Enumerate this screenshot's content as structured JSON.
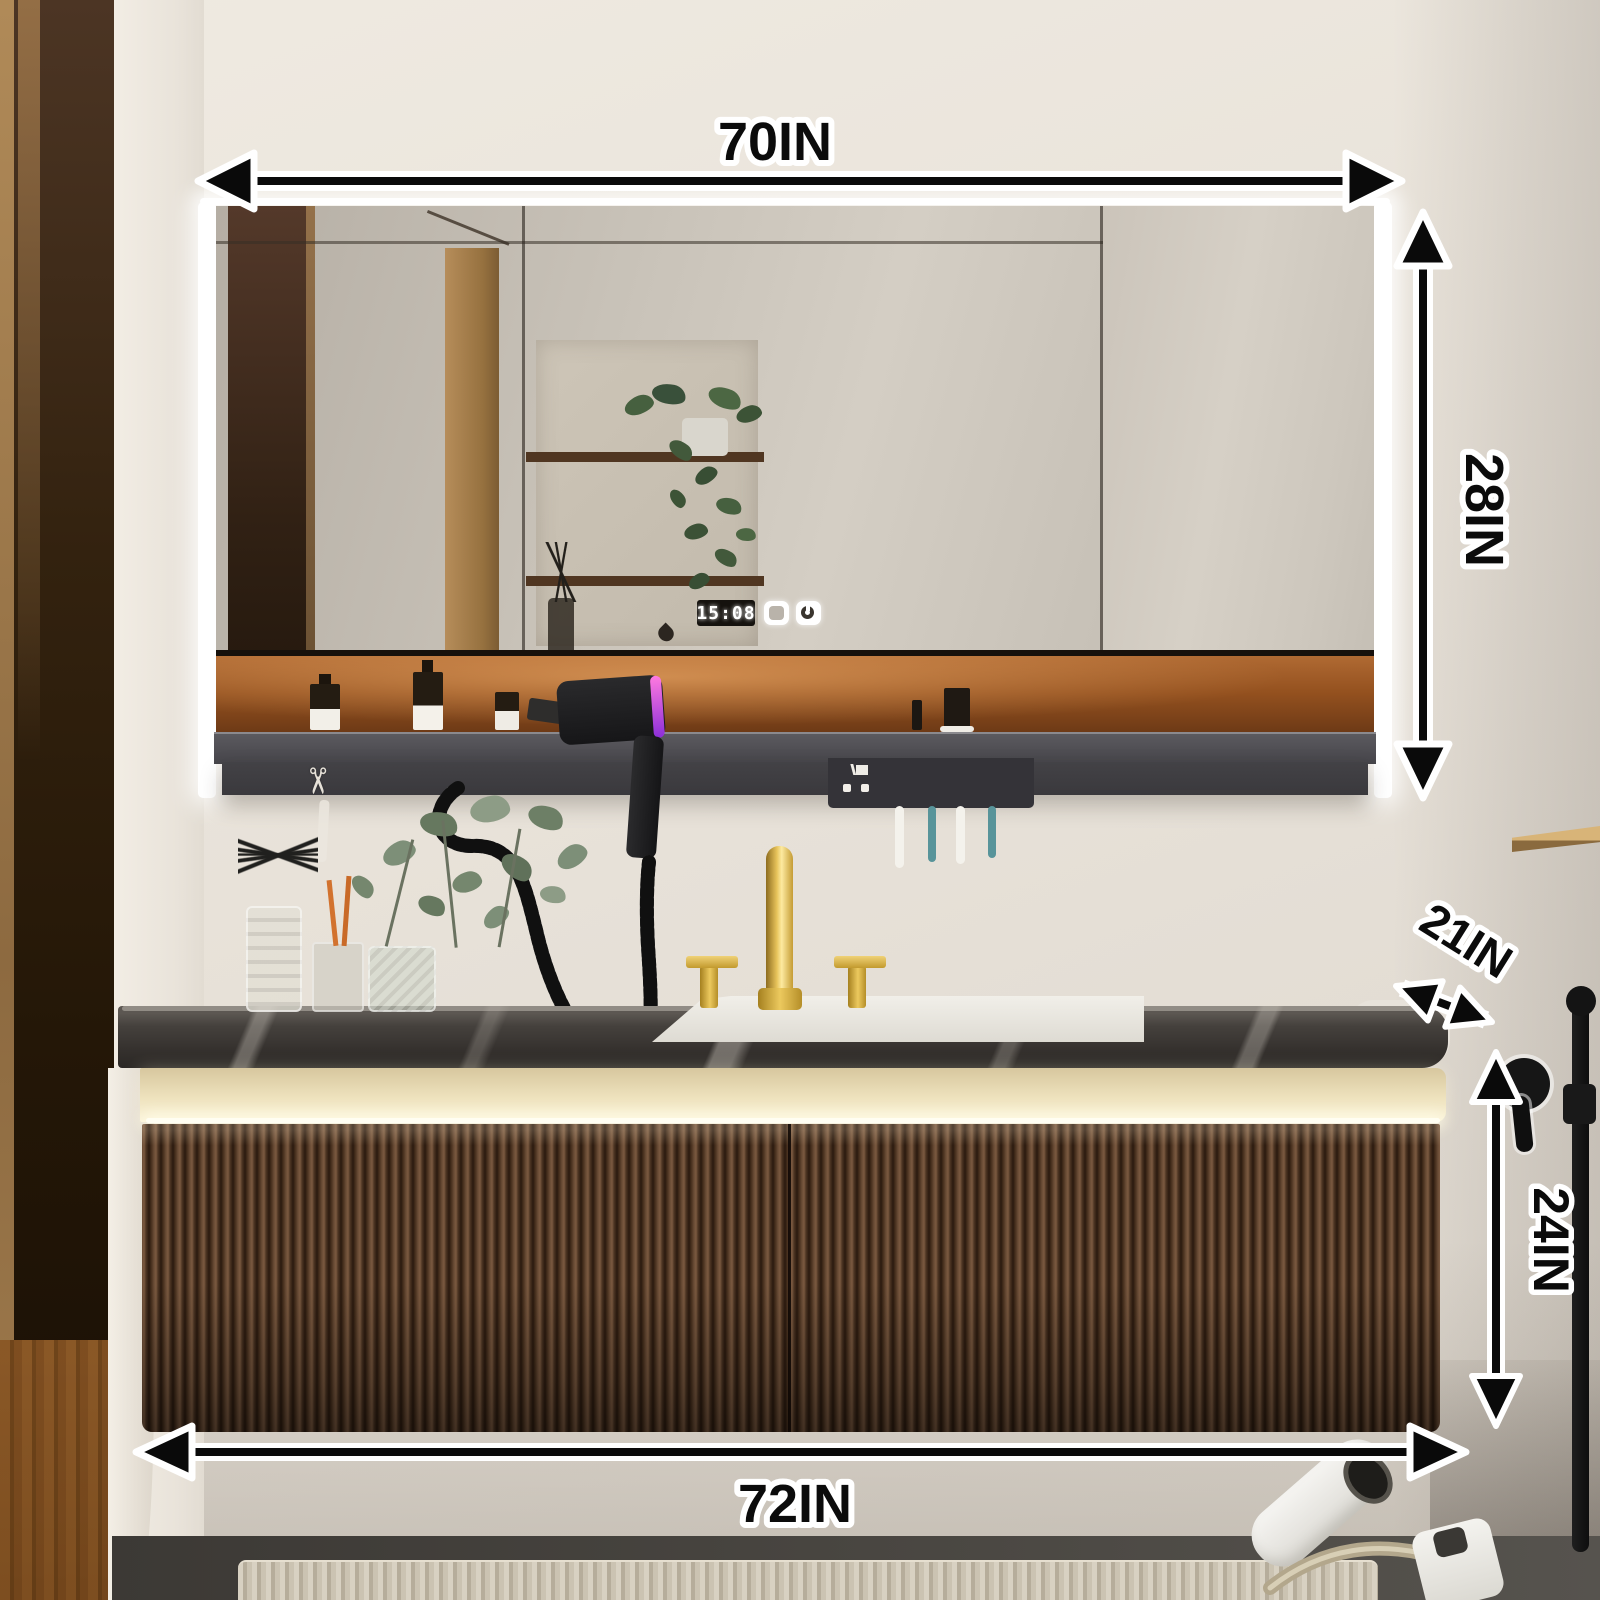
{
  "annotations": {
    "mirror_width": "70IN",
    "mirror_height": "28IN",
    "counter_depth": "21IN",
    "cabinet_height": "24IN",
    "vanity_width": "72IN"
  },
  "mirror_display": {
    "time": "15:08"
  },
  "glyphs": {
    "scissors": "✂"
  },
  "colors": {
    "wall": "#e8e2d9",
    "door_wood_dark": "#3a2817",
    "door_wood_light": "#b18a58",
    "mirror_glass": "#c9c3b9",
    "led_strip": "#ffffff",
    "amber_shelf": "#9c5524",
    "ledge_gray": "#4a494d",
    "marble_top": "#413d3a",
    "gold_band": "#efe2ba",
    "cabinet_walnut": "#4a3424",
    "faucet_gold": "#d4af4e",
    "toothbrush_teal": "#55929a",
    "dryer_black": "#1e1e20",
    "dryer_accent": "#c355d8",
    "annotation_ink": "#0a0a0a",
    "annotation_casing": "#ffffff"
  }
}
